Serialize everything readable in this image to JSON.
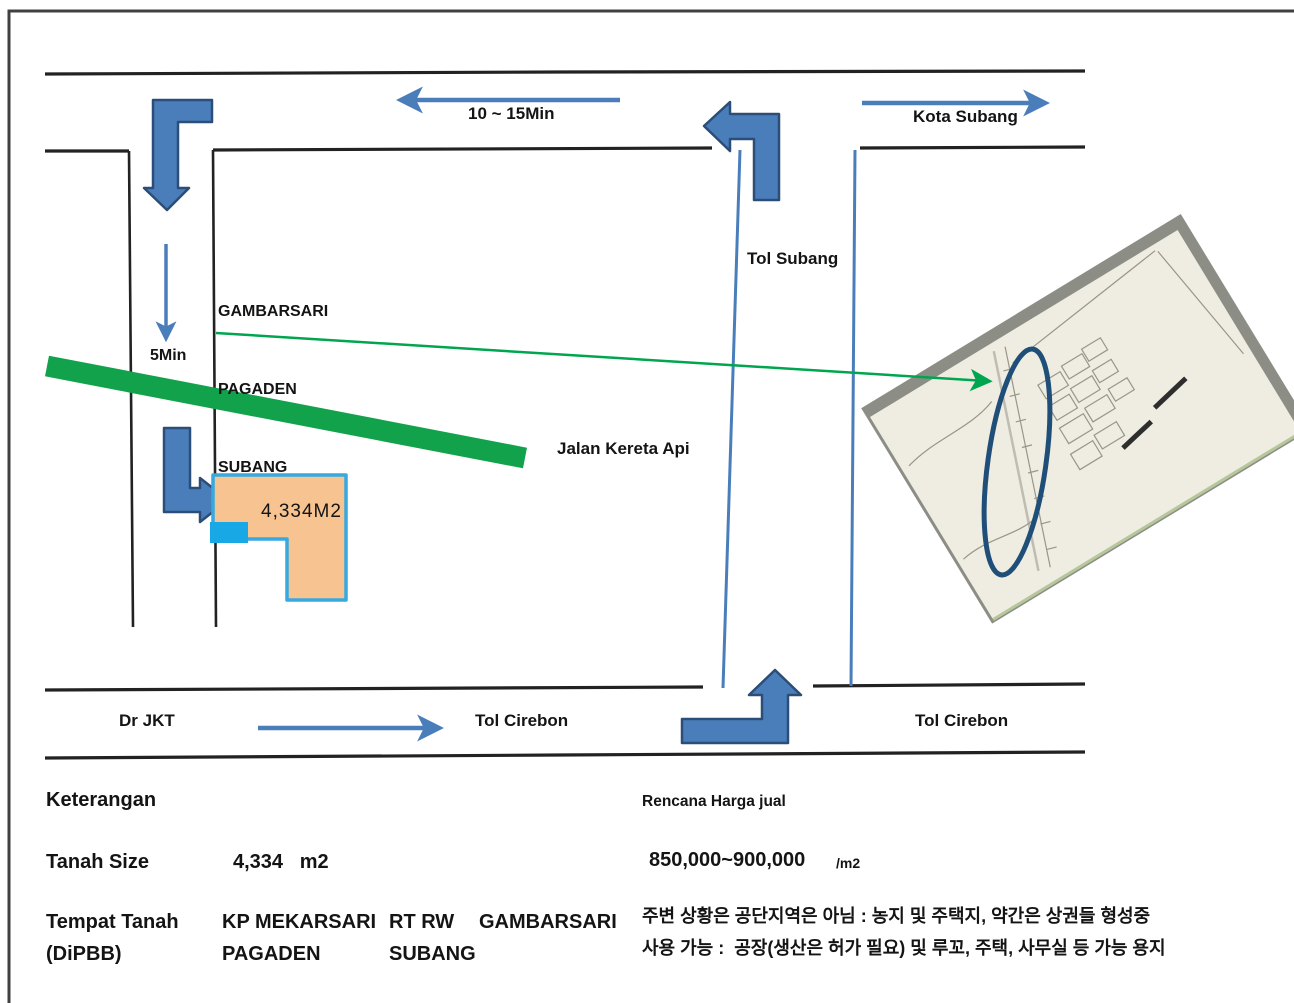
{
  "colors": {
    "road": "#222222",
    "frame": "#404040",
    "arrow-blue": "#4a7ebb",
    "arrow-dark": "#2c4d77",
    "green-band": "#12a24c",
    "green-arrow": "#00a550",
    "parcel-fill": "#f6c391",
    "parcel-border": "#36a9e0",
    "highlight-cyan": "#18a8e6",
    "ellipse-navy": "#1f4e79",
    "paper": "#efede1",
    "photo-edge": "#8c8d85",
    "map-line": "#98968a"
  },
  "map": {
    "top_left_time": "10 ~ 15Min",
    "top_right_dest": "Kota Subang",
    "area": {
      "line1": "GAMBARSARI",
      "line2": "PAGADEN",
      "line3": "SUBANG"
    },
    "time_side": "5Min",
    "toll_road": "Tol Subang",
    "railway": "Jalan Kereta Api",
    "parcel_area": "4,334M2",
    "bottom_from": "Dr JKT",
    "bottom_dest_mid": "Tol Cirebon",
    "bottom_dest_right": "Tol Cirebon"
  },
  "details": {
    "heading": "Keterangan",
    "price_heading": "Rencana Harga jual",
    "size_label": "Tanah Size",
    "size_value": "4,334   m2",
    "price_value": "850,000~900,000",
    "price_unit": "/m2",
    "location_label_1": "Tempat Tanah",
    "location_label_2": "(DiPBB)",
    "location_kp": "KP MEKARSARI",
    "location_kp_2": "PAGADEN",
    "location_rt": "RT RW",
    "location_rt_2": "SUBANG",
    "location_area": "GAMBARSARI",
    "note_1": "주변 상황은 공단지역은 아님 : 농지 및 주택지, 약간은 상권들 형성중",
    "note_2": "사용 가능 :  공장(생산은 허가 필요) 및 루꼬, 주택, 사무실 등 가능 용지"
  }
}
